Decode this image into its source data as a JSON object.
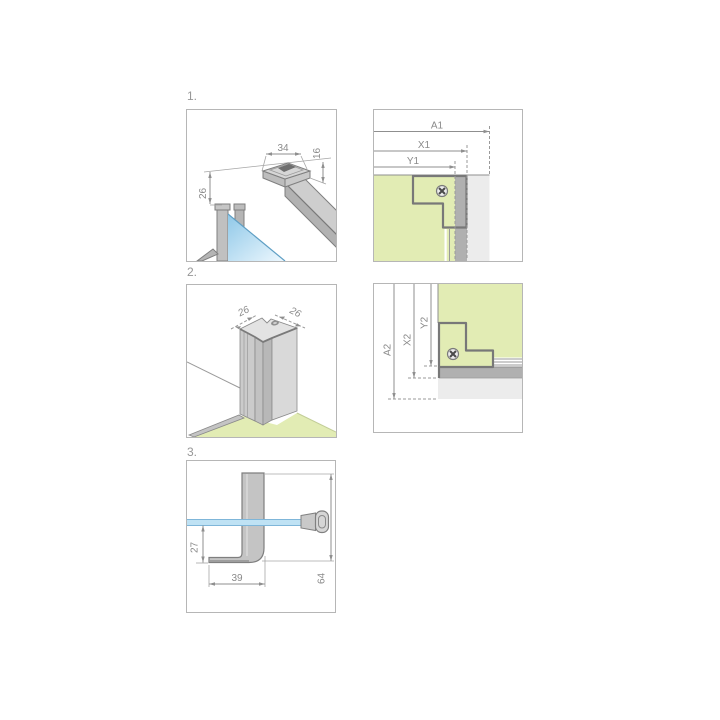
{
  "panels": {
    "step1": {
      "label": "1.",
      "dims": {
        "head_width": "34",
        "head_height": "16",
        "drop": "26"
      }
    },
    "detail1": {
      "dims": {
        "a": "A1",
        "x": "X1",
        "y": "Y1"
      }
    },
    "step2": {
      "label": "2.",
      "dims": {
        "left": "26",
        "right": "26"
      }
    },
    "detail2": {
      "dims": {
        "a": "A2",
        "x": "X2",
        "y": "Y2"
      }
    },
    "step3": {
      "label": "3.",
      "dims": {
        "drop": "27",
        "foot": "39",
        "height": "64"
      }
    }
  },
  "icons": {
    "screw": "phillips-screw"
  },
  "colors": {
    "panel_border": "#b6b6b6",
    "floor_green": "#e2ecb4",
    "glass_blue": "#bfe2f4",
    "glass_edge_blue": "#7fb6d9",
    "profile_gray": "#c4c4c4",
    "wall_gray": "#ececec",
    "strip_gray": "#b0b0b0",
    "outline_gray": "#7f7f7f",
    "dimension_gray": "#8a8a8a"
  }
}
